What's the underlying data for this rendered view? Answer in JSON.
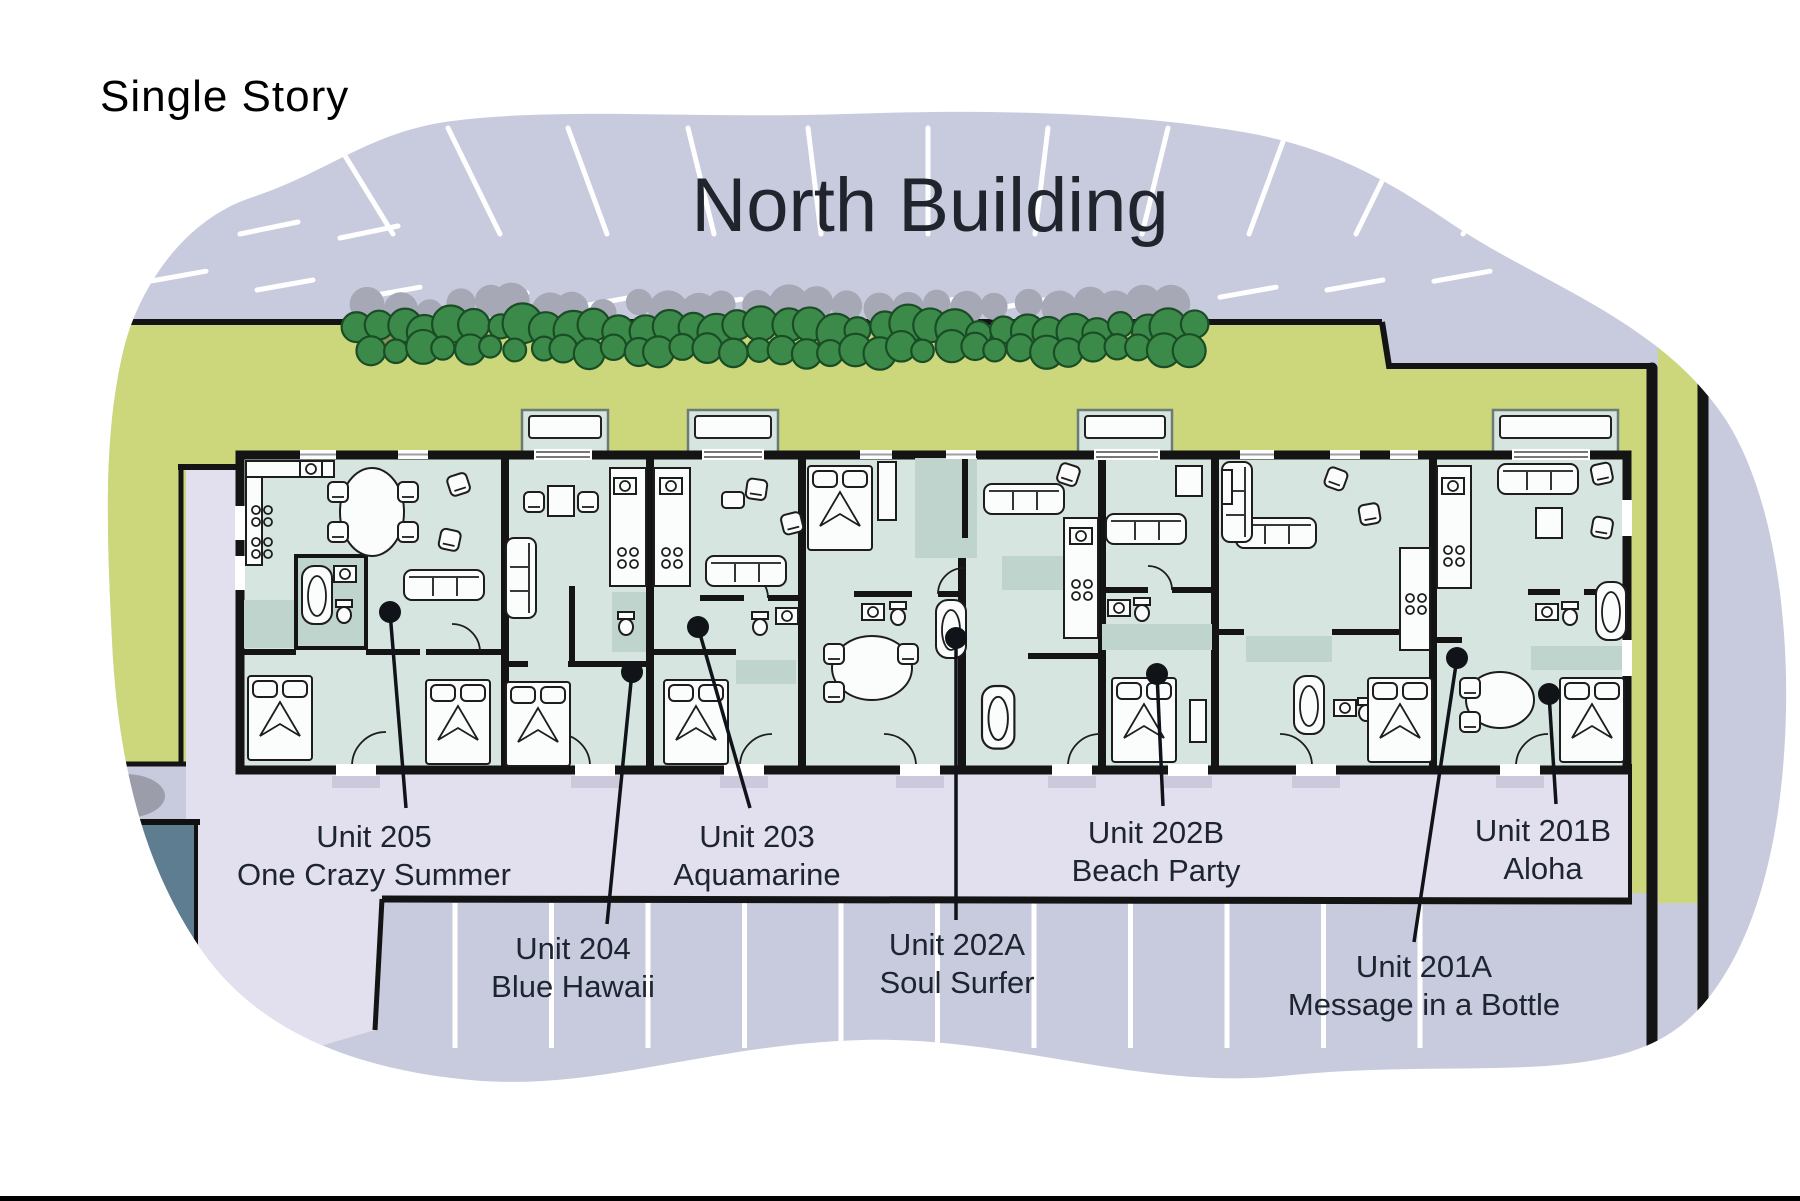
{
  "page": {
    "story_label": "Single Story",
    "building_title": "North Building"
  },
  "units": [
    {
      "id": "205",
      "label": "Unit 205",
      "name": "One Crazy Summer"
    },
    {
      "id": "204",
      "label": "Unit 204",
      "name": "Blue Hawaii"
    },
    {
      "id": "203",
      "label": "Unit 203",
      "name": "Aquamarine"
    },
    {
      "id": "202A",
      "label": "Unit 202A",
      "name": "Soul Surfer"
    },
    {
      "id": "202B",
      "label": "Unit 202B",
      "name": "Beach Party"
    },
    {
      "id": "201A",
      "label": "Unit 201A",
      "name": "Message in a Bottle"
    },
    {
      "id": "201B",
      "label": "Unit 201B",
      "name": "Aloha"
    }
  ],
  "colors": {
    "parking": "#c8cbde",
    "walkway": "#e2dfee",
    "grass": "#ccd77b",
    "hedge": "#3c8a49",
    "hedge_outline": "#1a4d26",
    "hedge_shadow": "#a6a8b5",
    "floor": "#d7e5e0",
    "floor_shade": "#bfd4cd",
    "wall": "#141414",
    "neighbor_roof": "#5f7d90",
    "label_text": "#1d2530",
    "title_text": "#20242c"
  }
}
